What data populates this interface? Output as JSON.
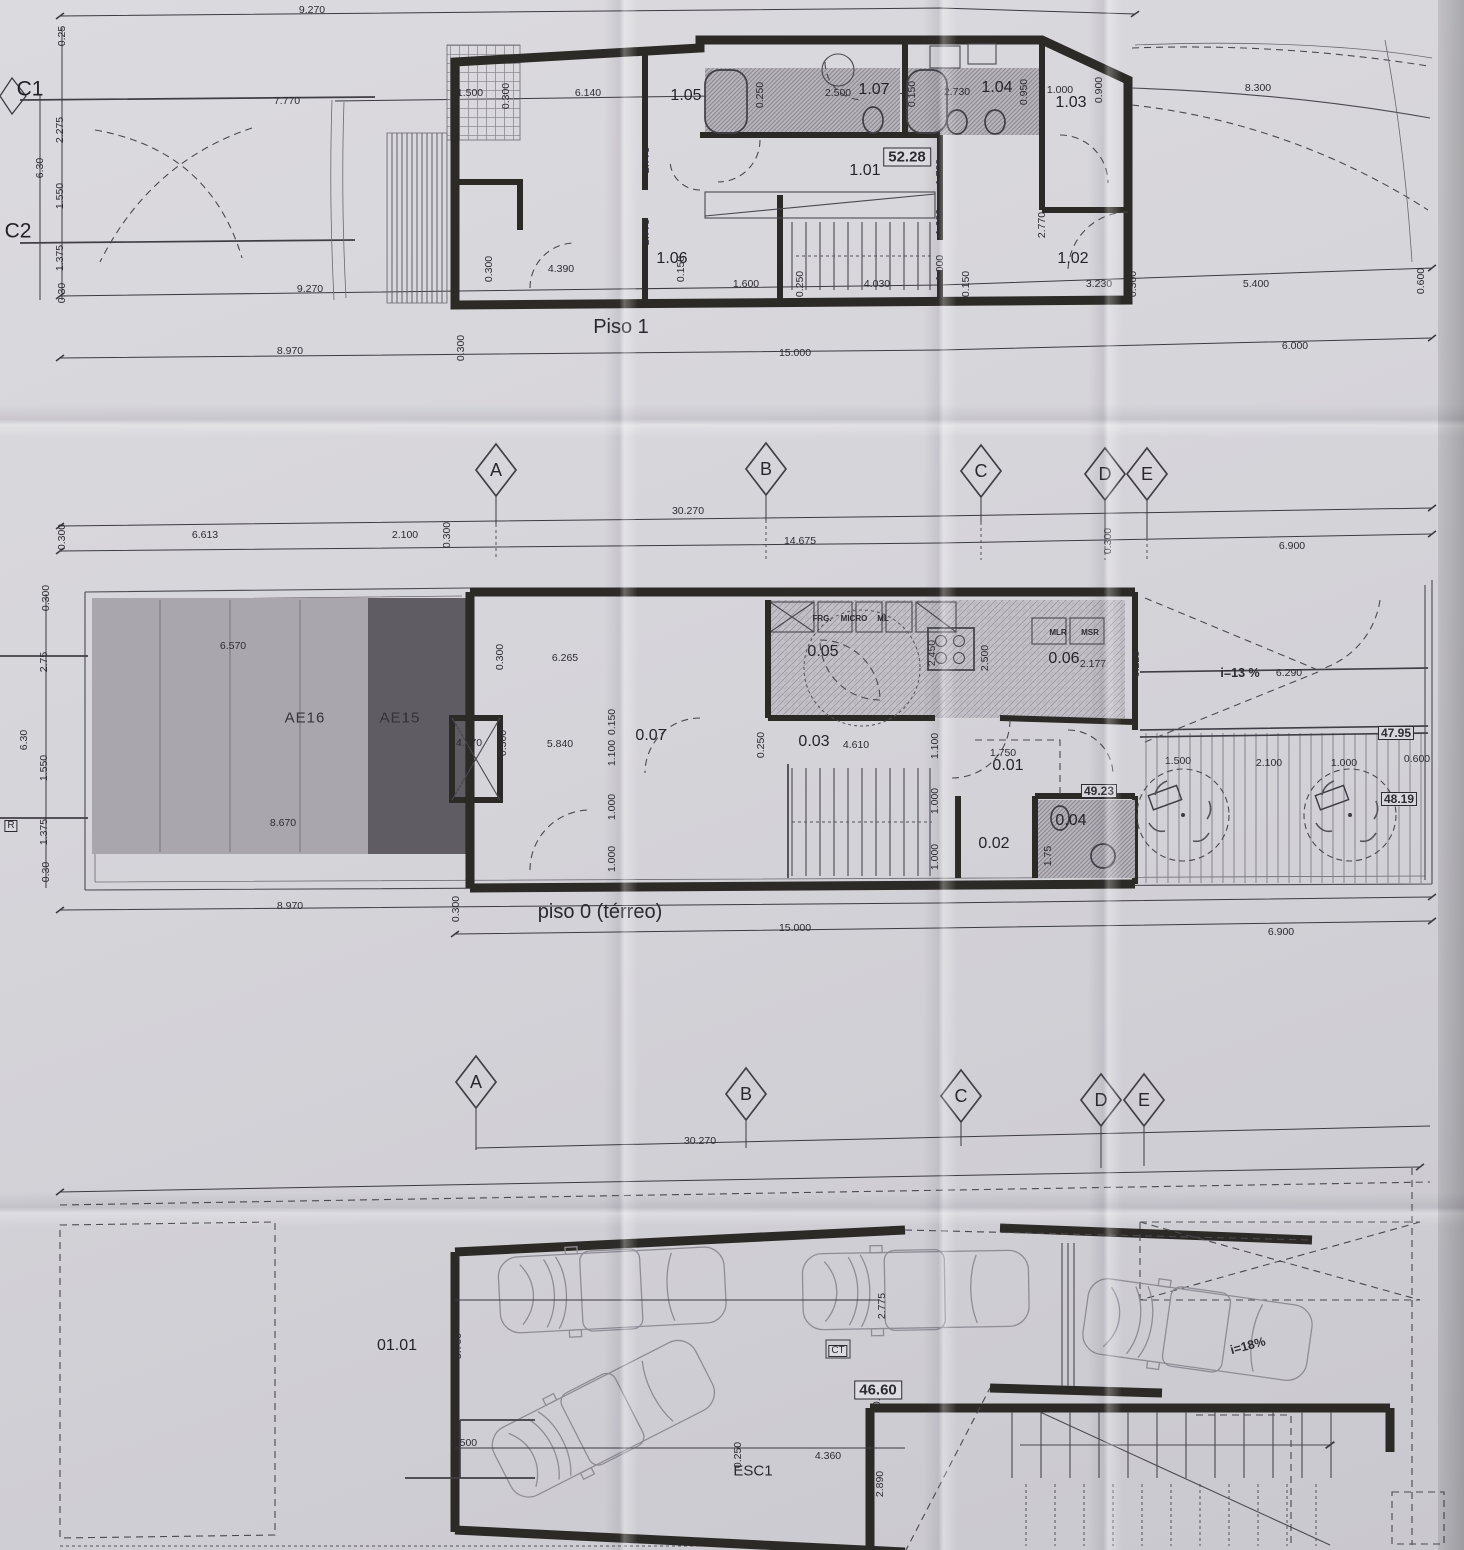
{
  "document": {
    "kind": "scanned architectural floor plan sheet"
  },
  "plans": {
    "piso1": {
      "title": "Piso 1",
      "area_badge": "52.28"
    },
    "piso0": {
      "title": "piso 0 (térreo)"
    },
    "garagem": {
      "area_badge": "46.60",
      "stair_label": "ESC1"
    }
  },
  "annotations": {
    "piso1": [
      {
        "t": "9.270",
        "x": 312,
        "y": 10,
        "k": "dim"
      },
      {
        "t": "7.770",
        "x": 287,
        "y": 101,
        "k": "dim"
      },
      {
        "t": "C1",
        "x": 30,
        "y": 89,
        "k": "side"
      },
      {
        "t": "C2",
        "x": 18,
        "y": 231,
        "k": "side"
      },
      {
        "t": "0.25",
        "x": 62,
        "y": 36,
        "k": "dimr"
      },
      {
        "t": "2.275",
        "x": 60,
        "y": 130,
        "k": "dimr"
      },
      {
        "t": "6.30",
        "x": 40,
        "y": 168,
        "k": "dimr"
      },
      {
        "t": "1.550",
        "x": 60,
        "y": 196,
        "k": "dimr"
      },
      {
        "t": "1.375",
        "x": 60,
        "y": 258,
        "k": "dimr"
      },
      {
        "t": "0.30",
        "x": 62,
        "y": 293,
        "k": "dimr"
      },
      {
        "t": "1.500",
        "x": 470,
        "y": 93,
        "k": "dim"
      },
      {
        "t": "0.300",
        "x": 506,
        "y": 96,
        "k": "dimr"
      },
      {
        "t": "6.140",
        "x": 588,
        "y": 93,
        "k": "dim"
      },
      {
        "t": "2.775",
        "x": 646,
        "y": 160,
        "k": "dimr"
      },
      {
        "t": "2.775",
        "x": 646,
        "y": 232,
        "k": "dimr"
      },
      {
        "t": "1.05",
        "x": 686,
        "y": 96,
        "k": "room"
      },
      {
        "t": "1.06",
        "x": 672,
        "y": 259,
        "k": "room"
      },
      {
        "t": "0.250",
        "x": 760,
        "y": 95,
        "k": "dimr"
      },
      {
        "t": "2.500",
        "x": 838,
        "y": 93,
        "k": "dim"
      },
      {
        "t": "1.07",
        "x": 874,
        "y": 90,
        "k": "room"
      },
      {
        "t": "0.150",
        "x": 912,
        "y": 94,
        "k": "dimr"
      },
      {
        "t": "2.730",
        "x": 957,
        "y": 92,
        "k": "dim"
      },
      {
        "t": "1.04",
        "x": 997,
        "y": 88,
        "k": "room"
      },
      {
        "t": "0.950",
        "x": 1024,
        "y": 92,
        "k": "dimr"
      },
      {
        "t": "1.000",
        "x": 1060,
        "y": 90,
        "k": "dim"
      },
      {
        "t": "0.900",
        "x": 1099,
        "y": 90,
        "k": "dimr"
      },
      {
        "t": "1.03",
        "x": 1071,
        "y": 103,
        "k": "room"
      },
      {
        "t": "8.300",
        "x": 1258,
        "y": 88,
        "k": "dim"
      },
      {
        "t": "1.01",
        "x": 865,
        "y": 171,
        "k": "room"
      },
      {
        "t": "1.700",
        "x": 940,
        "y": 172,
        "k": "dimr"
      },
      {
        "t": "1.000",
        "x": 940,
        "y": 222,
        "k": "dimr"
      },
      {
        "t": "1.000",
        "x": 940,
        "y": 268,
        "k": "dimr"
      },
      {
        "t": "2.770",
        "x": 1042,
        "y": 225,
        "k": "dimr"
      },
      {
        "t": "1.02",
        "x": 1073,
        "y": 259,
        "k": "room"
      },
      {
        "t": "0.300",
        "x": 489,
        "y": 269,
        "k": "dimr"
      },
      {
        "t": "4.390",
        "x": 561,
        "y": 269,
        "k": "dim"
      },
      {
        "t": "0.150",
        "x": 681,
        "y": 269,
        "k": "dimr"
      },
      {
        "t": "1.600",
        "x": 746,
        "y": 284,
        "k": "dim"
      },
      {
        "t": "0.250",
        "x": 800,
        "y": 284,
        "k": "dimr"
      },
      {
        "t": "4.030",
        "x": 877,
        "y": 284,
        "k": "dim"
      },
      {
        "t": "0.150",
        "x": 966,
        "y": 284,
        "k": "dimr"
      },
      {
        "t": "3.230",
        "x": 1099,
        "y": 284,
        "k": "dim"
      },
      {
        "t": "0.300",
        "x": 1133,
        "y": 284,
        "k": "dimr"
      },
      {
        "t": "5.400",
        "x": 1256,
        "y": 284,
        "k": "dim"
      },
      {
        "t": "0.600",
        "x": 1421,
        "y": 281,
        "k": "dimr"
      },
      {
        "t": "9.270",
        "x": 310,
        "y": 289,
        "k": "dim"
      },
      {
        "t": "8.970",
        "x": 290,
        "y": 351,
        "k": "dim"
      },
      {
        "t": "0.300",
        "x": 461,
        "y": 348,
        "k": "dimr"
      },
      {
        "t": "15.000",
        "x": 795,
        "y": 353,
        "k": "dim"
      },
      {
        "t": "6.000",
        "x": 1295,
        "y": 346,
        "k": "dim"
      }
    ],
    "grid_row1": [
      {
        "t": "A",
        "x": 496,
        "y": 470,
        "k": "grid"
      },
      {
        "t": "B",
        "x": 766,
        "y": 469,
        "k": "grid"
      },
      {
        "t": "C",
        "x": 981,
        "y": 471,
        "k": "grid"
      },
      {
        "t": "D",
        "x": 1105,
        "y": 474,
        "k": "grid"
      },
      {
        "t": "E",
        "x": 1147,
        "y": 474,
        "k": "grid"
      },
      {
        "t": "30.270",
        "x": 688,
        "y": 511,
        "k": "dim"
      },
      {
        "t": "2.100",
        "x": 405,
        "y": 535,
        "k": "dim"
      },
      {
        "t": "0.300",
        "x": 447,
        "y": 535,
        "k": "dimr"
      },
      {
        "t": "14.675",
        "x": 800,
        "y": 541,
        "k": "dim"
      },
      {
        "t": "0.300",
        "x": 1108,
        "y": 541,
        "k": "dimr"
      },
      {
        "t": "0.300",
        "x": 62,
        "y": 537,
        "k": "dimr"
      },
      {
        "t": "6.613",
        "x": 205,
        "y": 535,
        "k": "dim"
      },
      {
        "t": "6.900",
        "x": 1292,
        "y": 546,
        "k": "dim"
      }
    ],
    "piso0": [
      {
        "t": "0.300",
        "x": 46,
        "y": 598,
        "k": "dimr"
      },
      {
        "t": "2.75",
        "x": 44,
        "y": 662,
        "k": "dimr"
      },
      {
        "t": "6.30",
        "x": 24,
        "y": 740,
        "k": "dimr"
      },
      {
        "t": "1.550",
        "x": 44,
        "y": 768,
        "k": "dimr"
      },
      {
        "t": "1.375",
        "x": 44,
        "y": 832,
        "k": "dimr"
      },
      {
        "t": "0.30",
        "x": 46,
        "y": 872,
        "k": "dimr"
      },
      {
        "t": "R",
        "x": 11,
        "y": 826,
        "k": "boxed"
      },
      {
        "t": "6.570",
        "x": 233,
        "y": 646,
        "k": "dim"
      },
      {
        "t": "AE16",
        "x": 305,
        "y": 718,
        "k": "zone"
      },
      {
        "t": "AE15",
        "x": 400,
        "y": 718,
        "k": "zone"
      },
      {
        "t": "8.670",
        "x": 283,
        "y": 823,
        "k": "dim"
      },
      {
        "t": "0.300",
        "x": 500,
        "y": 657,
        "k": "dimr"
      },
      {
        "t": "6.265",
        "x": 565,
        "y": 658,
        "k": "dim"
      },
      {
        "t": "2.450",
        "x": 932,
        "y": 653,
        "k": "dimr"
      },
      {
        "t": "2.500",
        "x": 985,
        "y": 658,
        "k": "dimr"
      },
      {
        "t": "FRG.",
        "x": 822,
        "y": 619,
        "k": "fix"
      },
      {
        "t": "MICRO",
        "x": 854,
        "y": 619,
        "k": "fix"
      },
      {
        "t": "ML",
        "x": 883,
        "y": 619,
        "k": "fix"
      },
      {
        "t": "MLR",
        "x": 1058,
        "y": 633,
        "k": "fix"
      },
      {
        "t": "MSR",
        "x": 1090,
        "y": 633,
        "k": "fix"
      },
      {
        "t": "0.05",
        "x": 823,
        "y": 652,
        "k": "room"
      },
      {
        "t": "0.06",
        "x": 1064,
        "y": 659,
        "k": "room"
      },
      {
        "t": "2.177",
        "x": 1093,
        "y": 664,
        "k": "dim"
      },
      {
        "t": "0.228",
        "x": 1136,
        "y": 664,
        "k": "dimr"
      },
      {
        "t": "i=13 %",
        "x": 1240,
        "y": 673,
        "k": "note"
      },
      {
        "t": "6.290",
        "x": 1289,
        "y": 673,
        "k": "dim"
      },
      {
        "t": "47.95",
        "x": 1396,
        "y": 733,
        "k": "badge2"
      },
      {
        "t": "4.370",
        "x": 469,
        "y": 743,
        "k": "dim"
      },
      {
        "t": "0.300",
        "x": 503,
        "y": 743,
        "k": "dimr"
      },
      {
        "t": "5.840",
        "x": 560,
        "y": 744,
        "k": "dim"
      },
      {
        "t": "0.07",
        "x": 651,
        "y": 736,
        "k": "room"
      },
      {
        "t": "0.150",
        "x": 612,
        "y": 722,
        "k": "dimr"
      },
      {
        "t": "1.100",
        "x": 612,
        "y": 753,
        "k": "dimr"
      },
      {
        "t": "1.000",
        "x": 612,
        "y": 807,
        "k": "dimr"
      },
      {
        "t": "1.000",
        "x": 612,
        "y": 859,
        "k": "dimr"
      },
      {
        "t": "0.250",
        "x": 761,
        "y": 745,
        "k": "dimr"
      },
      {
        "t": "0.03",
        "x": 814,
        "y": 742,
        "k": "room"
      },
      {
        "t": "4.610",
        "x": 856,
        "y": 745,
        "k": "dim"
      },
      {
        "t": "1.100",
        "x": 935,
        "y": 746,
        "k": "dimr"
      },
      {
        "t": "1.000",
        "x": 935,
        "y": 801,
        "k": "dimr"
      },
      {
        "t": "1.000",
        "x": 935,
        "y": 857,
        "k": "dimr"
      },
      {
        "t": "1.750",
        "x": 1003,
        "y": 753,
        "k": "dim"
      },
      {
        "t": "0.01",
        "x": 1008,
        "y": 766,
        "k": "room"
      },
      {
        "t": "49.23",
        "x": 1099,
        "y": 791,
        "k": "badge2"
      },
      {
        "t": "0.02",
        "x": 994,
        "y": 844,
        "k": "room"
      },
      {
        "t": "0.04",
        "x": 1071,
        "y": 821,
        "k": "room"
      },
      {
        "t": "1.75",
        "x": 1048,
        "y": 856,
        "k": "dimr"
      },
      {
        "t": "1.500",
        "x": 1178,
        "y": 761,
        "k": "dim"
      },
      {
        "t": "2.100",
        "x": 1269,
        "y": 763,
        "k": "dim"
      },
      {
        "t": "1.000",
        "x": 1344,
        "y": 763,
        "k": "dim"
      },
      {
        "t": "0.600",
        "x": 1417,
        "y": 759,
        "k": "dim"
      },
      {
        "t": "48.19",
        "x": 1399,
        "y": 799,
        "k": "badge2"
      },
      {
        "t": "8.970",
        "x": 290,
        "y": 906,
        "k": "dim"
      },
      {
        "t": "0.300",
        "x": 456,
        "y": 909,
        "k": "dimr"
      },
      {
        "t": "15.000",
        "x": 795,
        "y": 928,
        "k": "dim"
      },
      {
        "t": "6.900",
        "x": 1281,
        "y": 932,
        "k": "dim"
      }
    ],
    "grid_row2": [
      {
        "t": "A",
        "x": 476,
        "y": 1082,
        "k": "grid"
      },
      {
        "t": "B",
        "x": 746,
        "y": 1094,
        "k": "grid"
      },
      {
        "t": "C",
        "x": 961,
        "y": 1096,
        "k": "grid"
      },
      {
        "t": "D",
        "x": 1101,
        "y": 1100,
        "k": "grid"
      },
      {
        "t": "E",
        "x": 1144,
        "y": 1100,
        "k": "grid"
      },
      {
        "t": "30.270",
        "x": 700,
        "y": 1141,
        "k": "dim"
      }
    ],
    "garagem": [
      {
        "t": "01.01",
        "x": 397,
        "y": 1346,
        "k": "room"
      },
      {
        "t": "5.700",
        "x": 458,
        "y": 1346,
        "k": "dimr"
      },
      {
        "t": "4.500",
        "x": 464,
        "y": 1443,
        "k": "dim"
      },
      {
        "t": "CT",
        "x": 838,
        "y": 1351,
        "k": "boxed"
      },
      {
        "t": "2.775",
        "x": 882,
        "y": 1306,
        "k": "dimr"
      },
      {
        "t": "0.775",
        "x": 877,
        "y": 1394,
        "k": "dimr"
      },
      {
        "t": "0.250",
        "x": 738,
        "y": 1455,
        "k": "dimr"
      },
      {
        "t": "4.360",
        "x": 828,
        "y": 1456,
        "k": "dim"
      },
      {
        "t": "2.890",
        "x": 880,
        "y": 1484,
        "k": "dimr"
      },
      {
        "t": "i=18%",
        "x": 1248,
        "y": 1346,
        "k": "note",
        "r": -15
      }
    ]
  }
}
